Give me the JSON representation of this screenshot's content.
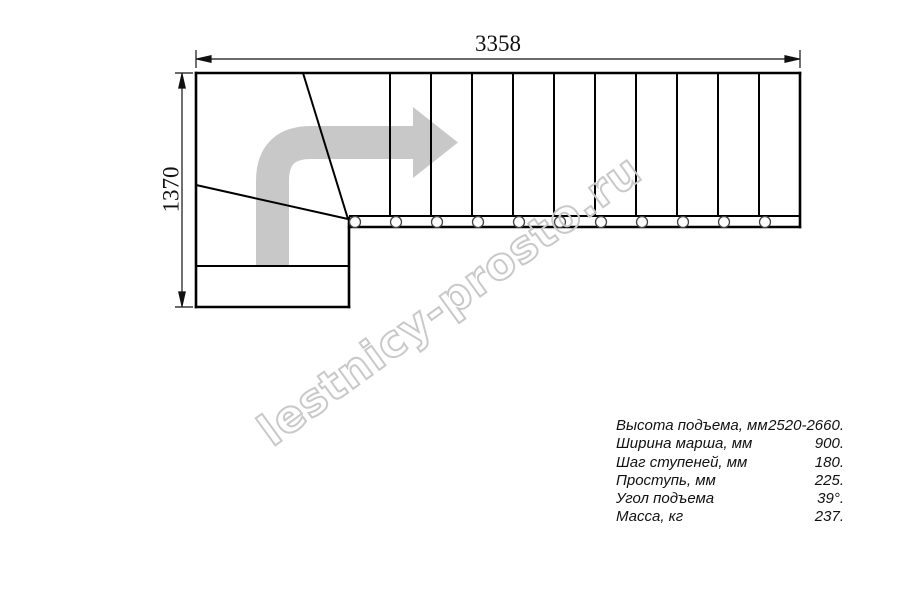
{
  "drawing": {
    "type": "staircase-plan-top-view",
    "dimensions": {
      "total_length_mm": "3358",
      "total_depth_mm": "1370"
    },
    "watermark": {
      "text": "lestnicy-prosto.ru",
      "color": "#c9c9c9"
    },
    "plan": {
      "straight_treads": 11,
      "winder_treads": 3,
      "baluster_count": 11,
      "direction_arrow": "up-then-right-turn",
      "colors": {
        "line": "#000000",
        "arrow": "#c8c8c8"
      }
    },
    "specs": {
      "rows": [
        {
          "label": "Высота подъема, мм",
          "value": "2520-2660."
        },
        {
          "label": "Ширина марша, мм",
          "value": "900."
        },
        {
          "label": "Шаг ступеней, мм",
          "value": "180."
        },
        {
          "label": "Проступь, мм",
          "value": "225."
        },
        {
          "label": "Угол подъема",
          "value": "39°."
        },
        {
          "label": "Масса, кг",
          "value": "237."
        }
      ]
    }
  }
}
